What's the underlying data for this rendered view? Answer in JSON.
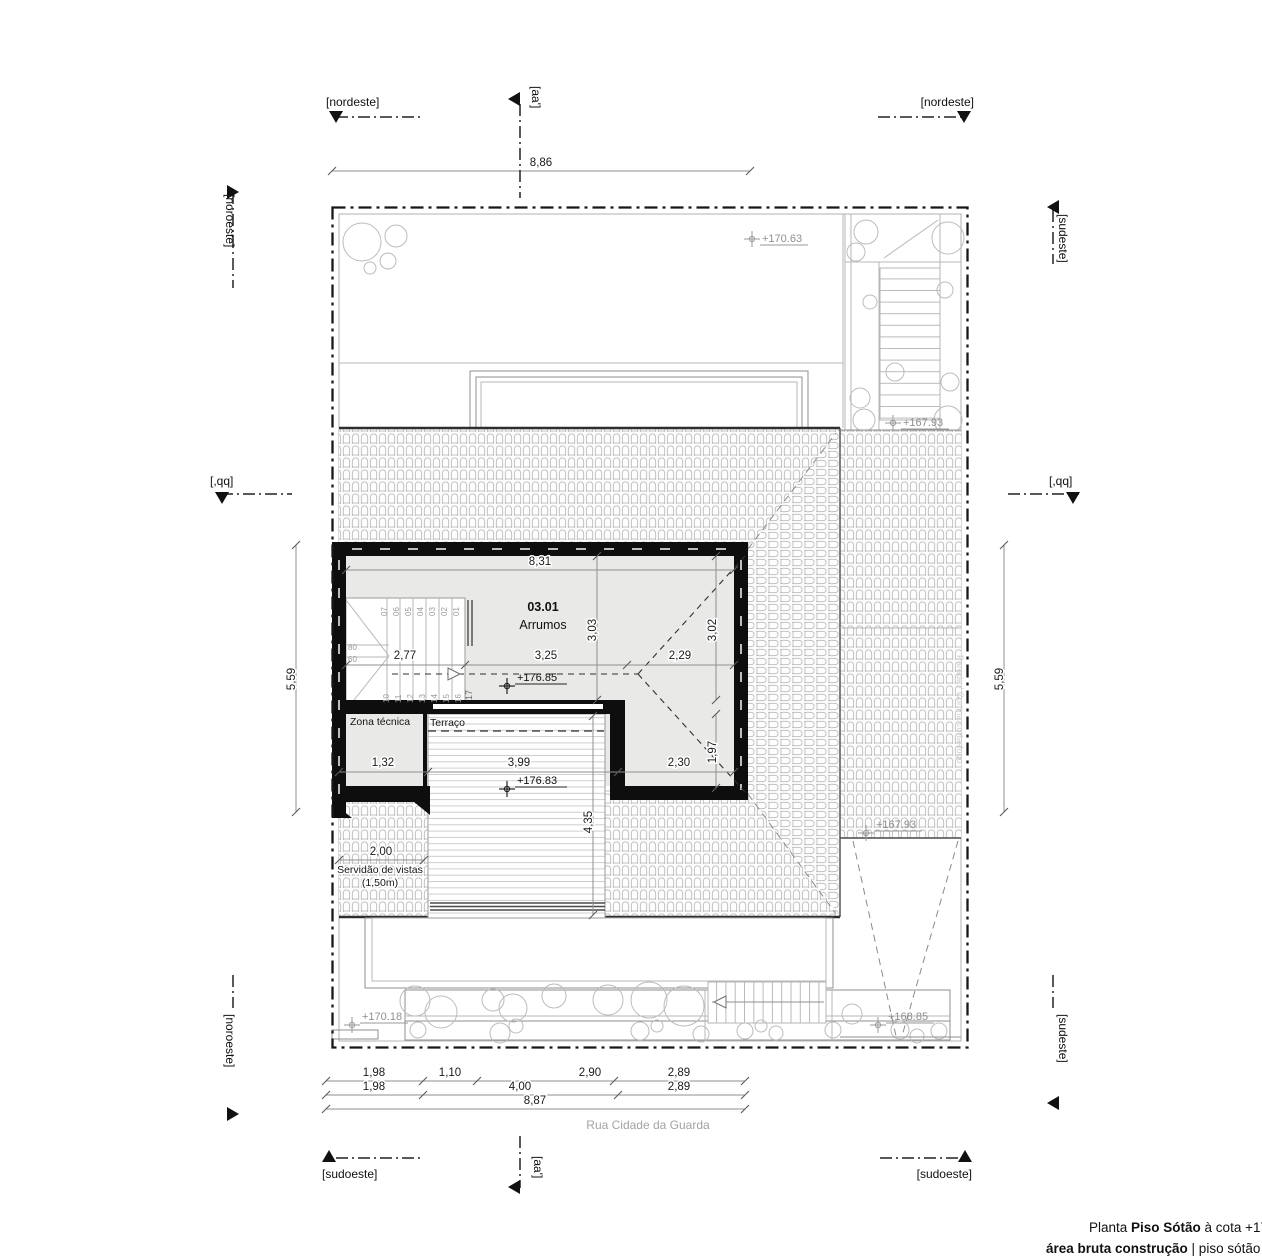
{
  "title": {
    "l1_prefix": "Planta ",
    "l1_name": "Piso Sótão",
    "l1_suffix": " à cota +178",
    "l2_bold": "área bruta construção",
    "l2_rest": " | piso sótão = 03"
  },
  "compass": {
    "nordeste": "[nordeste]",
    "noroeste": "[noroeste]",
    "sudeste": "[sudeste]",
    "sudoeste": "[sudoeste]",
    "aa": "[aa']",
    "qq": "[,qq]"
  },
  "street": {
    "name": "Rua Cidade da Guarda"
  },
  "building": {
    "room_no": "03.01",
    "room_name": "Arrumos",
    "zona": "Zona técnica",
    "terraco": "Terraço",
    "servidao_l1": "Servidão de vistas",
    "servidao_l2": "(1,50m)",
    "firewall": "Parede / Cortina corta-fogo"
  },
  "levels": {
    "e17063": "+170.63",
    "e16793": "+167.93",
    "e17685": "+176.85",
    "e17683": "+176.83",
    "e17018": "+170.18",
    "e16885": "+168.85"
  },
  "dims": {
    "d886": "8,86",
    "d887": "8,87",
    "d559": "5,59",
    "d831": "8,31",
    "d303": "3,03",
    "d302": "3,02",
    "d277": "2,77",
    "d325": "3,25",
    "d229": "2,29",
    "d132": "1,32",
    "d399": "3,99",
    "d230": "2,30",
    "d197": "1,97",
    "d435": "4,35",
    "d200": "2,00",
    "d198": "1,98",
    "d110": "1,10",
    "d290": "2,90",
    "d289": "2,89",
    "d400": "4,00"
  },
  "stair": {
    "top": [
      "07",
      "06",
      "05",
      "04",
      "03",
      "02",
      "01"
    ],
    "bottom": [
      "10",
      "11",
      "12",
      "13",
      "14",
      "15",
      "16",
      "17"
    ],
    "w80": "80",
    "w60": "60"
  }
}
